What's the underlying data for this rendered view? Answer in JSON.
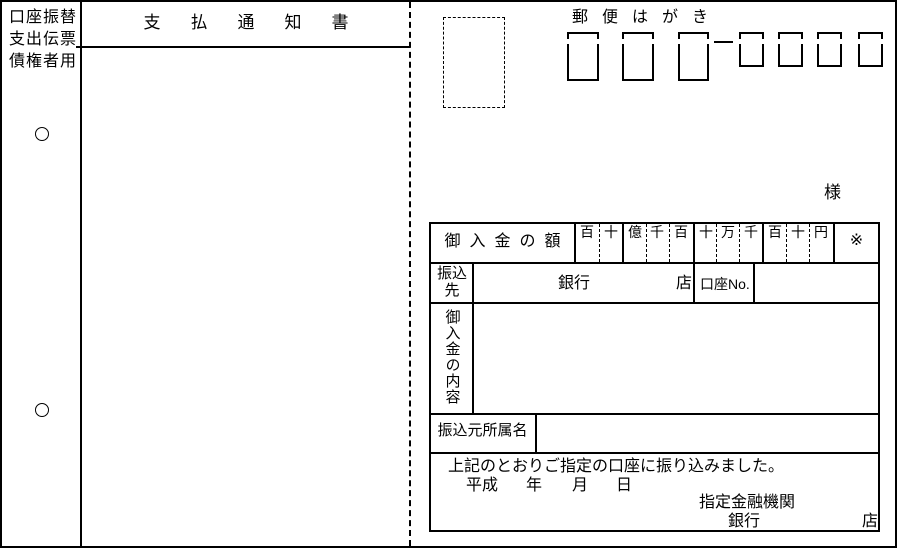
{
  "stub": {
    "lines": [
      "口座振替",
      "支出伝票",
      "債権者用"
    ]
  },
  "notice": {
    "title": "支払通知書"
  },
  "postcard": {
    "title": "郵便はがき",
    "addressee_suffix": "様",
    "table": {
      "amount_label": "御入金の額",
      "digit_headers": [
        "百",
        "十",
        "億",
        "千",
        "百",
        "十",
        "万",
        "千",
        "百",
        "十",
        "円"
      ],
      "note_mark": "※",
      "payee_label": "振込先",
      "bank_label": "銀行",
      "branch_label": "店",
      "account_no_label": "口座No.",
      "content_label": "御入金の内容",
      "sender_label": "振込元所属名",
      "footer_message": "上記のとおりご指定の口座に振り込みました。",
      "era_label": "平成",
      "year_label": "年",
      "month_label": "月",
      "day_label": "日",
      "institution_label": "指定金融機関",
      "institution_bank_label": "銀行",
      "institution_branch_label": "店"
    }
  },
  "colors": {
    "line": "#000000",
    "background": "#ffffff"
  }
}
